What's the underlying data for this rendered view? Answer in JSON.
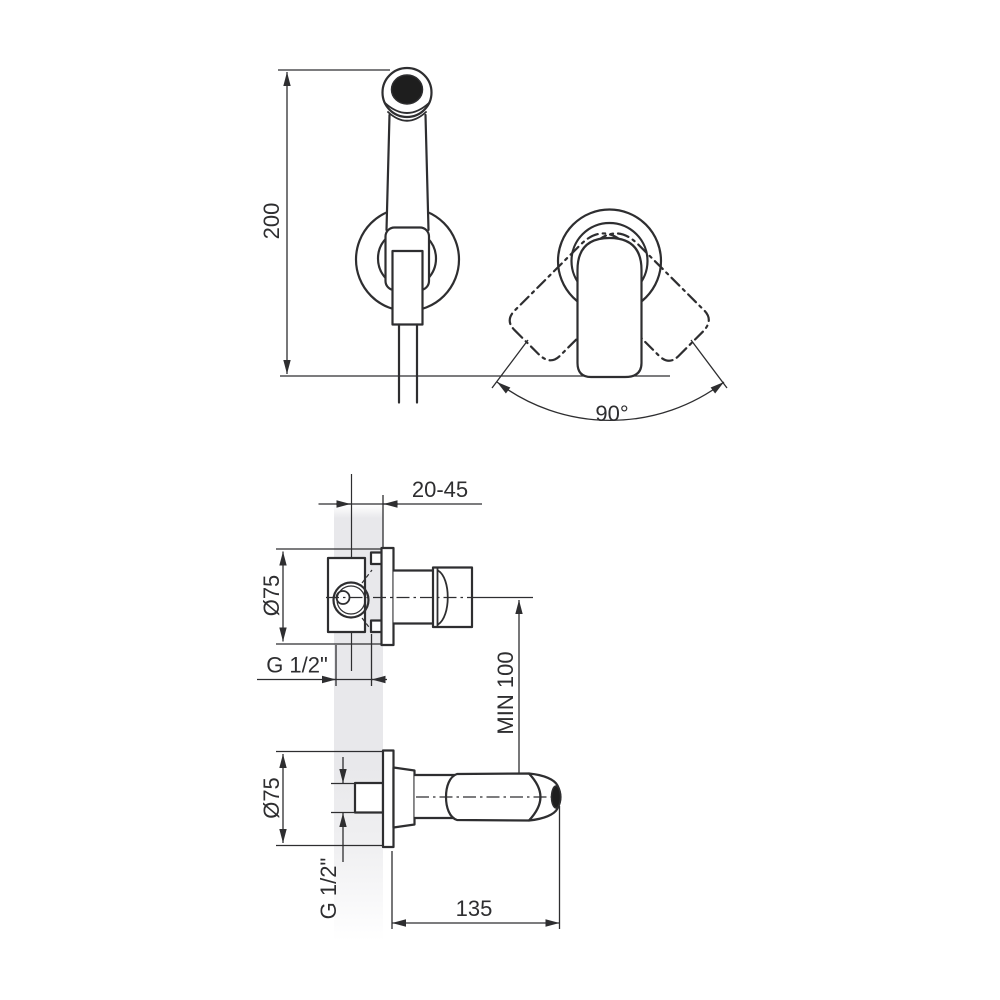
{
  "colors": {
    "background": "#ffffff",
    "line": "#2e2e30",
    "wall": "#e7e7ea",
    "nozzle": "#1e1e1e"
  },
  "drawing": {
    "front_view": {
      "height_label": "200",
      "swivel_angle_label": "90°"
    },
    "valve_section_view": {
      "wall_depth_label": "20-45",
      "escutcheon_diameter_label": "Ø75",
      "thread_label": "G 1/2\"",
      "min_clearance_label": "MIN 100"
    },
    "holder_section_view": {
      "escutcheon_diameter_label": "Ø75",
      "thread_label": "G 1/2\"",
      "projection_length_label": "135"
    }
  }
}
